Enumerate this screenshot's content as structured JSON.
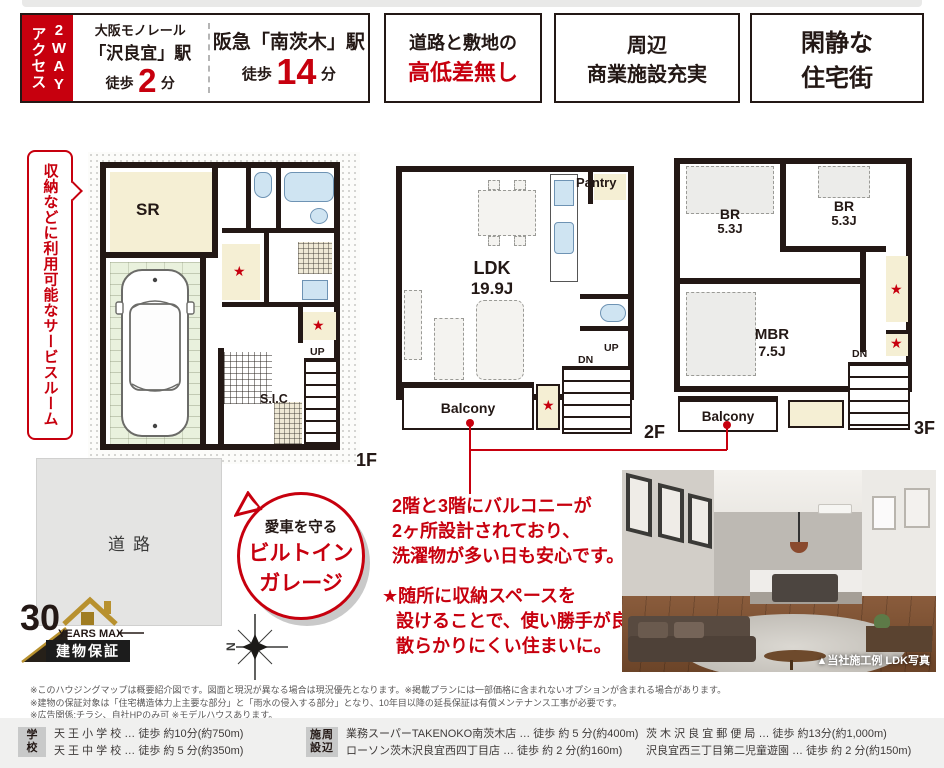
{
  "colors": {
    "accent_red": "#c7000e",
    "wall_dark": "#231815",
    "gold": "#b8912f"
  },
  "header": {
    "access_tab": {
      "line1": "2WAY",
      "line2": "アクセス"
    },
    "station1": {
      "rail": "大阪モノレール",
      "station": "「沢良宜」駅",
      "walk": "徒歩",
      "minutes": "2",
      "unit": "分"
    },
    "station2": {
      "station": "阪急「南茨木」駅",
      "walk": "徒歩",
      "minutes": "14",
      "unit": "分"
    },
    "feature1": {
      "line1": "道路と敷地の",
      "line2": "高低差無し"
    },
    "feature2": {
      "line1": "周辺",
      "line2": "商業施設充実"
    },
    "feature3": {
      "line1": "閑静な",
      "line2": "住宅街"
    }
  },
  "callout_service_room": "収納などに利用可能なサービスルーム",
  "garage_bubble": {
    "line1": "愛車を守る",
    "line2": "ビルトイン",
    "line3": "ガレージ"
  },
  "notes": {
    "balcony": [
      "2階と3階にバルコニーが",
      "2ヶ所設計されており、",
      "洗濯物が多い日も安心です。"
    ],
    "storage": [
      "★随所に収納スペースを",
      "設けることで、使い勝手が良く",
      "散らかりにくい住まいに。"
    ]
  },
  "floorplans": {
    "star": "★",
    "f1": {
      "label": "1F",
      "sr": "SR",
      "sic": "S.I.C",
      "up": "UP"
    },
    "f2": {
      "label": "2F",
      "ldk": "LDK",
      "ldk_size": "19.9J",
      "pantry": "Pantry",
      "balcony": "Balcony",
      "up": "UP",
      "dn": "DN"
    },
    "f3": {
      "label": "3F",
      "br": "BR",
      "br_size": "5.3J",
      "br2": "BR",
      "br2_size": "5.3J",
      "mbr": "MBR",
      "mbr_size": "7.5J",
      "balcony": "Balcony",
      "dn": "DN"
    }
  },
  "site": {
    "road": "道路",
    "compass_n": "N"
  },
  "warranty": {
    "years": "30",
    "years_max": "YEARS MAX",
    "label": "建物保証"
  },
  "photo": {
    "caption": "▲当社施工例 LDK写真"
  },
  "disclaimers": [
    "※このハウジングマップは概要紹介図です。図面と現況が異なる場合は現況優先となります。※掲載プランには一部価格に含まれないオプションが含まれる場合があります。",
    "※建物の保証対象は「住宅構造体力上主要な部分」と「雨水の侵入する部分」となり、10年目以降の延長保証は有償メンテナンス工事が必要です。",
    "※広告関係:チラシ、自社HPのみ可 ※モデルハウスあります。"
  ],
  "footer": {
    "school_label": {
      "line1": "学",
      "line2": "校"
    },
    "schools": [
      "天 王 小 学 校 … 徒歩 約10分(約750m)",
      "天 王 中 学 校 … 徒歩 約 5 分(約350m)"
    ],
    "facility_label": {
      "line1": "施周",
      "line2": "設辺"
    },
    "facilities_left": [
      "業務スーパーTAKENOKO南茨木店 … 徒歩 約 5 分(約400m)",
      "ローソン茨木沢良宜西四丁目店 … 徒歩 約 2 分(約160m)"
    ],
    "facilities_right": [
      "茨 木 沢 良 宜 郵 便 局 … 徒歩 約13分(約1,000m)",
      "沢良宜西三丁目第二児童遊園 … 徒歩 約 2 分(約150m)"
    ]
  }
}
